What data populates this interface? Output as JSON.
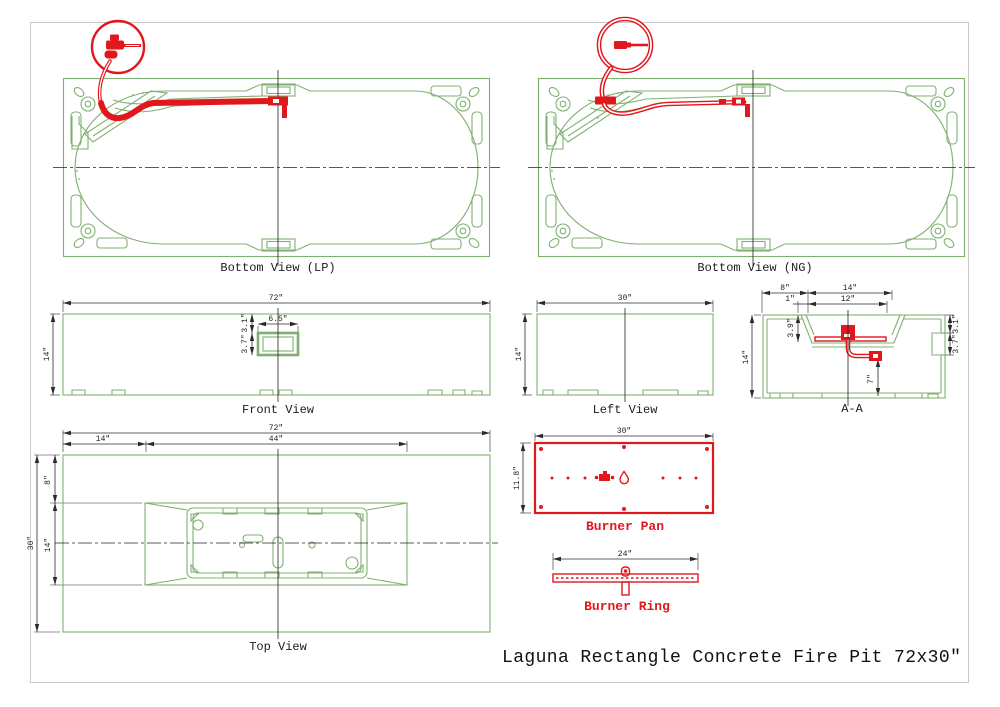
{
  "title": "Laguna Rectangle Concrete Fire Pit 72x30″",
  "colors": {
    "line_green": "#7fb071",
    "accent_red": "#e2171c"
  },
  "views": {
    "bottom_lp": {
      "label": "Bottom View (LP)"
    },
    "bottom_ng": {
      "label": "Bottom View (NG)"
    },
    "front": {
      "label": "Front View",
      "dims": {
        "width": "72″",
        "height": "14″",
        "vent_width": "6.5″",
        "vent_top": "3.1″",
        "vent_height": "3.7″"
      }
    },
    "left": {
      "label": "Left View",
      "dims": {
        "width": "30″",
        "height": "14″"
      }
    },
    "section_aa": {
      "label": "A-A",
      "dims": {
        "ledge": "8″",
        "opening": "14″",
        "inset": "1″",
        "pan_width": "12″",
        "height": "14″",
        "basin_depth": "3.9″",
        "pipe_drop": "7″",
        "vent_top": "3.1″",
        "vent_height": "3.7″"
      }
    },
    "top": {
      "label": "Top View",
      "dims": {
        "width": "72″",
        "end_offset": "14″",
        "basin_width": "44″",
        "depth": "30″",
        "side_offset": "8″",
        "basin_depth": "14″"
      }
    },
    "burner_pan": {
      "label": "Burner Pan",
      "dims": {
        "width": "30″",
        "height": "11.8″"
      }
    },
    "burner_ring": {
      "label": "Burner Ring",
      "dims": {
        "width": "24″"
      }
    }
  }
}
